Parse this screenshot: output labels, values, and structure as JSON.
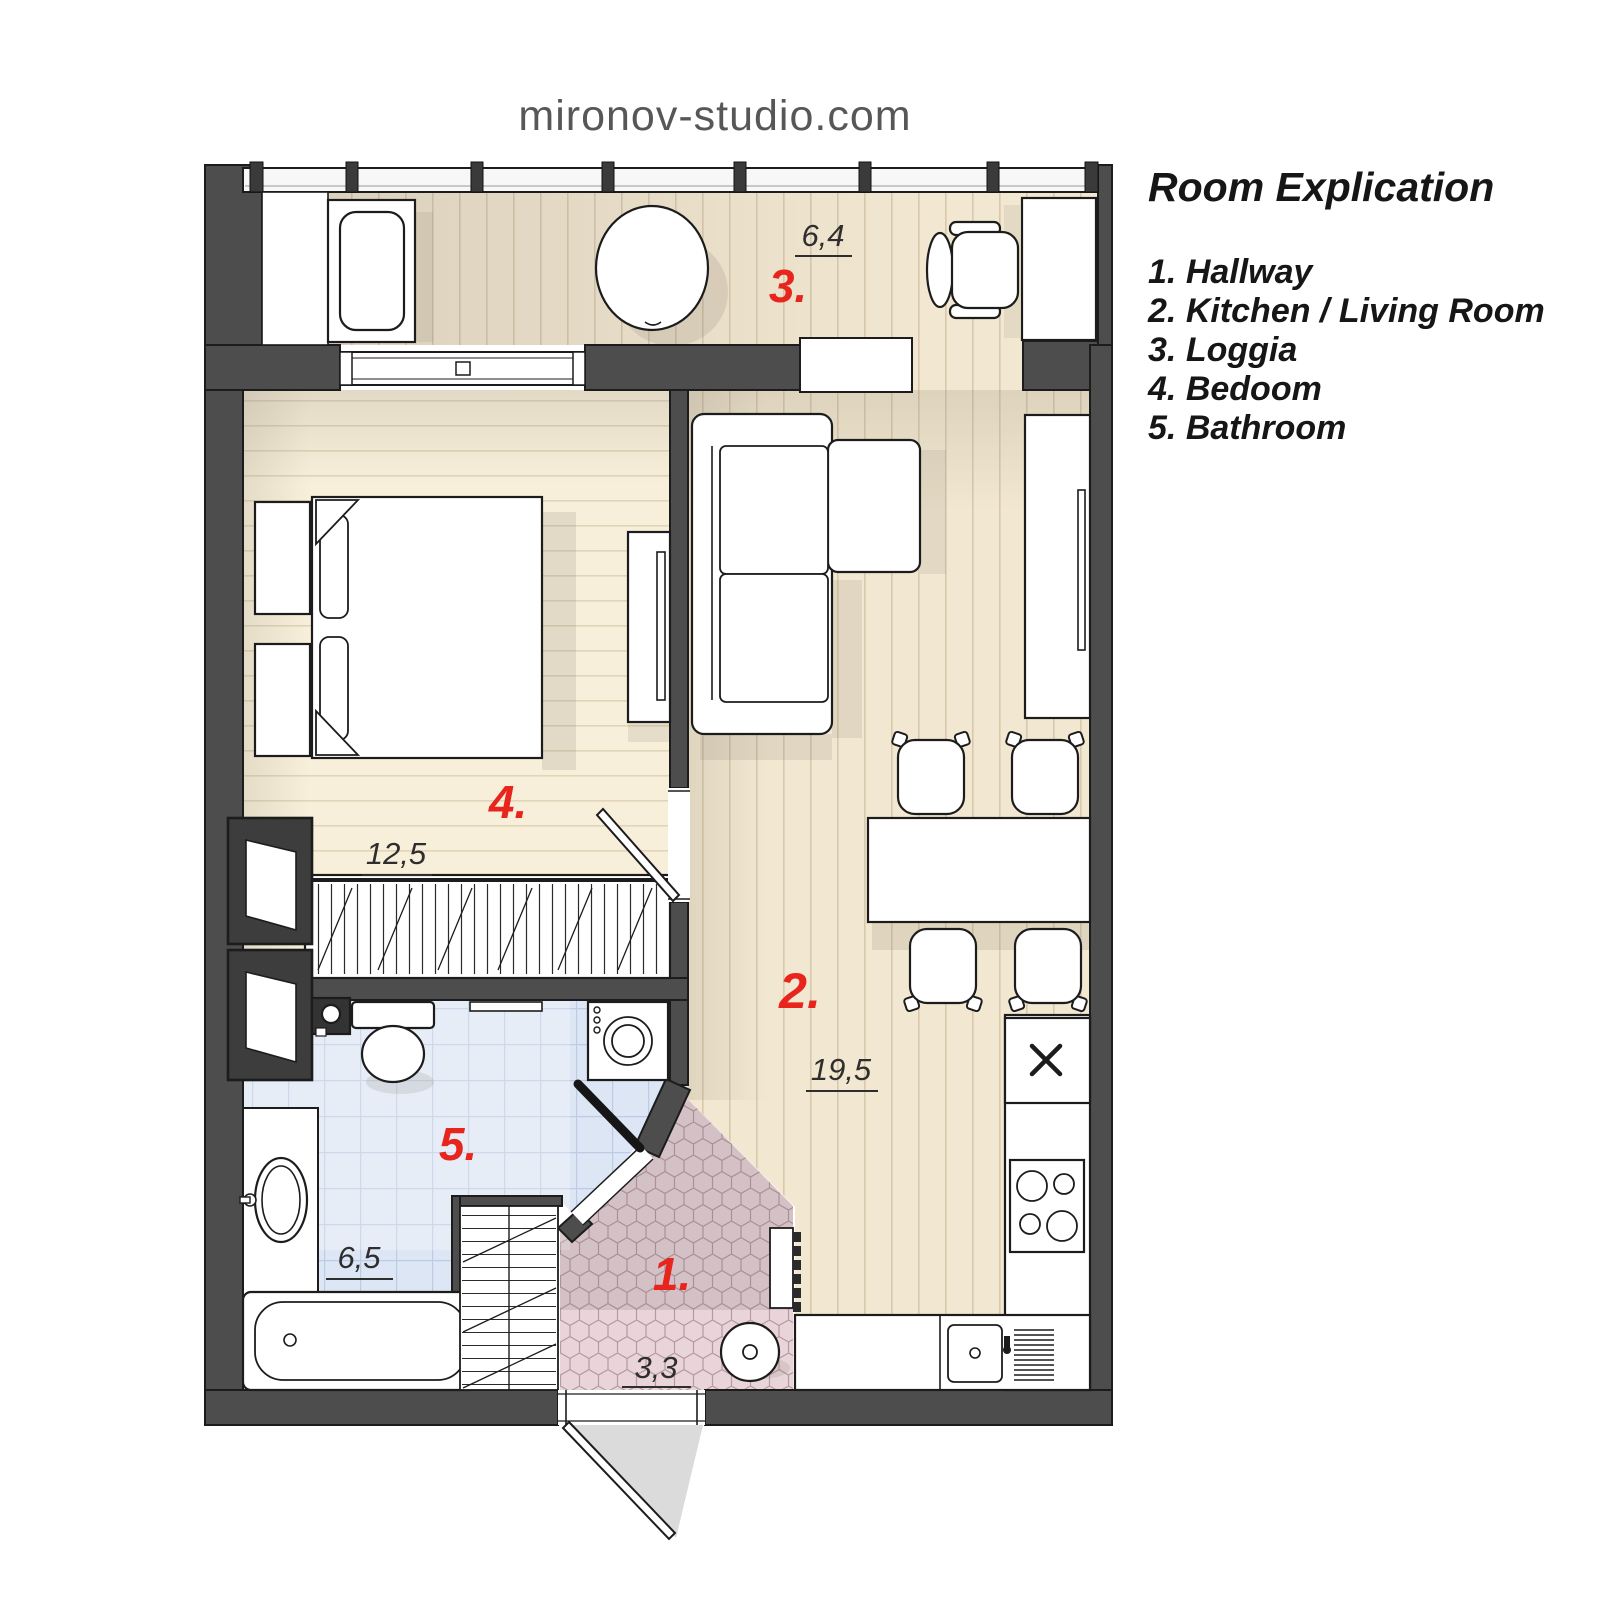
{
  "header": {
    "site_title": "mironov-studio.com"
  },
  "legend": {
    "title": "Room Explication",
    "items": [
      {
        "number": "1.",
        "label": "Hallway"
      },
      {
        "number": "2.",
        "label": "Kitchen / Living Room"
      },
      {
        "number": "3.",
        "label": "Loggia"
      },
      {
        "number": "4.",
        "label": "Bedoom"
      },
      {
        "number": "5.",
        "label": "Bathroom"
      }
    ]
  },
  "plan": {
    "rooms": [
      {
        "id": "hallway",
        "number": "1.",
        "area": "3,3"
      },
      {
        "id": "kitchen-living-room",
        "number": "2.",
        "area": "19,5"
      },
      {
        "id": "loggia",
        "number": "3.",
        "area": "6,4"
      },
      {
        "id": "bedroom",
        "number": "4.",
        "area": "12,5"
      },
      {
        "id": "bathroom",
        "number": "5.",
        "area": "6,5"
      }
    ],
    "colors": {
      "wall": "#4d4d4d",
      "room_number": "#e8251d",
      "area_label": "#2e2e2e",
      "wood_floor": "#f2e7d0",
      "bedroom_floor": "#f8efda",
      "bathroom_tile": "#dde6f4",
      "hallway_tile": "#e9d5d9"
    }
  }
}
